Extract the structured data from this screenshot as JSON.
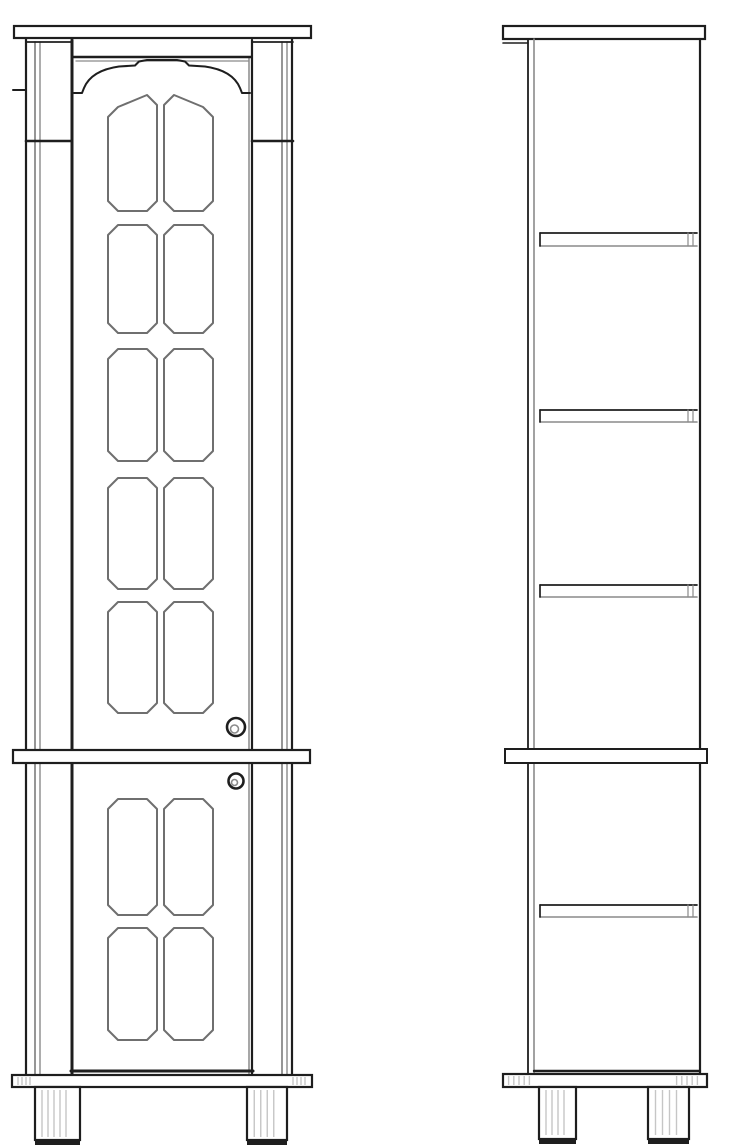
{
  "document": {
    "kind": "furniture-technical-drawing",
    "subject": "tall-cabinet",
    "views": [
      {
        "id": "front-elevation"
      },
      {
        "id": "side-elevation"
      }
    ]
  },
  "canvas": {
    "width": 745,
    "height": 1146,
    "background": "#ffffff"
  },
  "colors": {
    "ink": "#1e1e1e",
    "grey": "#8a8a8a",
    "mid": "#6f6f6f",
    "light": "#c6c6c6",
    "fill": "#ffffff"
  },
  "drawing": {
    "front": [
      {
        "t": "line",
        "name": "left-stile-outer-edge",
        "x1": 26,
        "y1": 38,
        "x2": 26,
        "y2": 1076,
        "sw": 2.2
      },
      {
        "t": "line",
        "name": "left-stile-inner-line-a",
        "x1": 35,
        "y1": 42,
        "x2": 35,
        "y2": 1076,
        "sw": 1.8,
        "c": "grey"
      },
      {
        "t": "line",
        "name": "left-stile-inner-line-b",
        "x1": 40,
        "y1": 42,
        "x2": 40,
        "y2": 1076,
        "sw": 1.4,
        "c": "grey"
      },
      {
        "t": "line",
        "name": "right-stile-inner-line-a",
        "x1": 282,
        "y1": 42,
        "x2": 282,
        "y2": 1076,
        "sw": 1.8,
        "c": "grey"
      },
      {
        "t": "line",
        "name": "right-stile-inner-line-b",
        "x1": 287,
        "y1": 42,
        "x2": 287,
        "y2": 1076,
        "sw": 1.4,
        "c": "grey"
      },
      {
        "t": "line",
        "name": "right-stile-outer-edge",
        "x1": 292,
        "y1": 38,
        "x2": 292,
        "y2": 1076,
        "sw": 2.2
      },
      {
        "t": "line",
        "name": "door-left-stile",
        "x1": 72,
        "y1": 40,
        "x2": 72,
        "y2": 1074,
        "sw": 3
      },
      {
        "t": "line",
        "name": "door-right-inner-line",
        "x1": 249,
        "y1": 58,
        "x2": 249,
        "y2": 1074,
        "sw": 1.5,
        "c": "grey"
      },
      {
        "t": "line",
        "name": "door-right-stile",
        "x1": 252,
        "y1": 40,
        "x2": 252,
        "y2": 1074,
        "sw": 2.2
      },
      {
        "t": "line",
        "name": "capital-top-left",
        "x1": 26,
        "y1": 42,
        "x2": 72,
        "y2": 42,
        "sw": 1.8
      },
      {
        "t": "line",
        "name": "capital-top-right",
        "x1": 252,
        "y1": 42,
        "x2": 293,
        "y2": 42,
        "sw": 1.8
      },
      {
        "t": "line",
        "name": "capital-bottom-left",
        "x1": 26,
        "y1": 141,
        "x2": 72,
        "y2": 141,
        "sw": 2.6
      },
      {
        "t": "line",
        "name": "capital-bottom-right",
        "x1": 252,
        "y1": 141,
        "x2": 293,
        "y2": 141,
        "sw": 2.6
      },
      {
        "t": "line",
        "name": "pilaster-collar-tick",
        "x1": 13,
        "y1": 90,
        "x2": 26,
        "y2": 90,
        "sw": 2
      },
      {
        "t": "line",
        "name": "door-top-rail",
        "x1": 73,
        "y1": 57,
        "x2": 251,
        "y2": 57,
        "sw": 2.4
      },
      {
        "t": "line",
        "name": "door-top-rail-shadow",
        "x1": 76,
        "y1": 61,
        "x2": 248,
        "y2": 61,
        "sw": 1.3,
        "c": "grey"
      },
      {
        "t": "path",
        "name": "door-arch",
        "d": "M74,93 L82,93 L84,88 C89,76 101,69 119,66.5 L135,65.5 L139,61.5 L147,60 L177,60 L185,61.5 L189,65.5 L205,66.5 C223,69 235,76 240,88 L242,93 L250,93",
        "sw": 2
      },
      {
        "t": "panel",
        "name": "upper-panel-r1-left",
        "x": 108,
        "y": 95,
        "w": 49,
        "h": 116,
        "tl": 12
      },
      {
        "t": "panel",
        "name": "upper-panel-r1-right",
        "x": 164,
        "y": 95,
        "w": 49,
        "h": 116,
        "tr": 12
      },
      {
        "t": "panel",
        "name": "upper-panel-r2-left",
        "x": 108,
        "y": 225,
        "w": 49,
        "h": 108
      },
      {
        "t": "panel",
        "name": "upper-panel-r2-right",
        "x": 164,
        "y": 225,
        "w": 49,
        "h": 108
      },
      {
        "t": "panel",
        "name": "upper-panel-r3-left",
        "x": 108,
        "y": 349,
        "w": 49,
        "h": 112
      },
      {
        "t": "panel",
        "name": "upper-panel-r3-right",
        "x": 164,
        "y": 349,
        "w": 49,
        "h": 112
      },
      {
        "t": "panel",
        "name": "upper-panel-r4-left",
        "x": 108,
        "y": 478,
        "w": 49,
        "h": 111
      },
      {
        "t": "panel",
        "name": "upper-panel-r4-right",
        "x": 164,
        "y": 478,
        "w": 49,
        "h": 111
      },
      {
        "t": "panel",
        "name": "upper-panel-r5-left",
        "x": 108,
        "y": 602,
        "w": 49,
        "h": 111
      },
      {
        "t": "panel",
        "name": "upper-panel-r5-right",
        "x": 164,
        "y": 602,
        "w": 49,
        "h": 111
      },
      {
        "t": "circle",
        "name": "upper-door-knob",
        "cx": 236,
        "cy": 727,
        "r": 9,
        "sw": 2.6
      },
      {
        "t": "circle",
        "name": "upper-door-knob-center",
        "cx": 234.5,
        "cy": 729,
        "r": 4,
        "sw": 1.6,
        "c": "grey"
      },
      {
        "t": "rect",
        "name": "middle-rail",
        "x": 13,
        "y": 750,
        "w": 297,
        "h": 13,
        "sw": 2.2,
        "f": "fill"
      },
      {
        "t": "circle",
        "name": "lower-door-knob",
        "cx": 236,
        "cy": 781,
        "r": 7.5,
        "sw": 2.6
      },
      {
        "t": "circle",
        "name": "lower-door-knob-center",
        "cx": 234.5,
        "cy": 782.5,
        "r": 3,
        "sw": 1.6,
        "c": "grey"
      },
      {
        "t": "panel",
        "name": "lower-panel-r1-left",
        "x": 108,
        "y": 799,
        "w": 49,
        "h": 116
      },
      {
        "t": "panel",
        "name": "lower-panel-r1-right",
        "x": 164,
        "y": 799,
        "w": 49,
        "h": 116
      },
      {
        "t": "panel",
        "name": "lower-panel-r2-left",
        "x": 108,
        "y": 928,
        "w": 49,
        "h": 112
      },
      {
        "t": "panel",
        "name": "lower-panel-r2-right",
        "x": 164,
        "y": 928,
        "w": 49,
        "h": 112
      },
      {
        "t": "line",
        "name": "door-bottom-rail",
        "x1": 71,
        "y1": 1071,
        "x2": 253,
        "y2": 1071,
        "sw": 3
      },
      {
        "t": "rect",
        "name": "plinth-rail",
        "x": 12,
        "y": 1075,
        "w": 300,
        "h": 12,
        "sw": 2.2,
        "f": "fill"
      },
      {
        "t": "hatch",
        "name": "plinth-hatch-left",
        "x": 16,
        "y": 1077,
        "w": 16,
        "h": 8,
        "n": 4
      },
      {
        "t": "hatch",
        "name": "plinth-hatch-right",
        "x": 291,
        "y": 1077,
        "w": 16,
        "h": 8,
        "n": 4
      },
      {
        "t": "rect",
        "name": "left-foot",
        "x": 35,
        "y": 1087,
        "w": 45,
        "h": 53,
        "sw": 2.2,
        "f": "fill"
      },
      {
        "t": "hatch",
        "name": "left-foot-hatch",
        "x": 39,
        "y": 1090,
        "w": 30,
        "h": 47,
        "n": 5
      },
      {
        "t": "rect",
        "name": "left-foot-base",
        "x": 35,
        "y": 1139,
        "w": 45,
        "h": 6,
        "sw": 0,
        "f": "ink"
      },
      {
        "t": "rect",
        "name": "right-foot",
        "x": 247,
        "y": 1087,
        "w": 40,
        "h": 53,
        "sw": 2.2,
        "f": "fill"
      },
      {
        "t": "hatch",
        "name": "right-foot-hatch",
        "x": 251,
        "y": 1090,
        "w": 26,
        "h": 47,
        "n": 4
      },
      {
        "t": "rect",
        "name": "right-foot-base",
        "x": 247,
        "y": 1139,
        "w": 40,
        "h": 6,
        "sw": 0,
        "f": "ink"
      },
      {
        "t": "rect",
        "name": "cornice-board",
        "x": 14,
        "y": 26,
        "w": 297,
        "h": 12,
        "sw": 2.2,
        "f": "fill"
      }
    ],
    "side": [
      {
        "t": "rect",
        "name": "top-board",
        "x": 503,
        "y": 26,
        "w": 202,
        "h": 13,
        "sw": 2.2,
        "f": "fill"
      },
      {
        "t": "line",
        "name": "top-board-lip",
        "x1": 503,
        "y1": 43,
        "x2": 528,
        "y2": 43,
        "sw": 1.6
      },
      {
        "t": "line",
        "name": "front-edge-outer",
        "x1": 528,
        "y1": 39,
        "x2": 528,
        "y2": 1075,
        "sw": 1.8
      },
      {
        "t": "line",
        "name": "front-edge-inner",
        "x1": 534,
        "y1": 39,
        "x2": 534,
        "y2": 1075,
        "sw": 1.6,
        "c": "grey"
      },
      {
        "t": "line",
        "name": "back-edge",
        "x1": 700,
        "y1": 39,
        "x2": 700,
        "y2": 1073,
        "sw": 2.2
      },
      {
        "t": "line",
        "name": "shelf-1-top",
        "x1": 540,
        "y1": 233,
        "x2": 697,
        "y2": 233,
        "sw": 1.7
      },
      {
        "t": "line",
        "name": "shelf-1-bottom",
        "x1": 540,
        "y1": 246,
        "x2": 697,
        "y2": 246,
        "sw": 1.6,
        "c": "grey"
      },
      {
        "t": "line",
        "name": "shelf-1-front-cap",
        "x1": 540,
        "y1": 233,
        "x2": 540,
        "y2": 246,
        "sw": 1.7
      },
      {
        "t": "line",
        "name": "shelf-1-peg-a",
        "x1": 688,
        "y1": 233,
        "x2": 688,
        "y2": 246,
        "sw": 1.2,
        "c": "grey"
      },
      {
        "t": "line",
        "name": "shelf-1-peg-b",
        "x1": 693,
        "y1": 233,
        "x2": 693,
        "y2": 246,
        "sw": 1.2,
        "c": "grey"
      },
      {
        "t": "line",
        "name": "shelf-2-top",
        "x1": 540,
        "y1": 410,
        "x2": 697,
        "y2": 410,
        "sw": 1.7
      },
      {
        "t": "line",
        "name": "shelf-2-bottom",
        "x1": 540,
        "y1": 422,
        "x2": 697,
        "y2": 422,
        "sw": 1.6,
        "c": "grey"
      },
      {
        "t": "line",
        "name": "shelf-2-front-cap",
        "x1": 540,
        "y1": 410,
        "x2": 540,
        "y2": 422,
        "sw": 1.7
      },
      {
        "t": "line",
        "name": "shelf-2-peg-a",
        "x1": 688,
        "y1": 410,
        "x2": 688,
        "y2": 422,
        "sw": 1.2,
        "c": "grey"
      },
      {
        "t": "line",
        "name": "shelf-2-peg-b",
        "x1": 693,
        "y1": 410,
        "x2": 693,
        "y2": 422,
        "sw": 1.2,
        "c": "grey"
      },
      {
        "t": "line",
        "name": "shelf-3-top",
        "x1": 540,
        "y1": 585,
        "x2": 697,
        "y2": 585,
        "sw": 1.7
      },
      {
        "t": "line",
        "name": "shelf-3-bottom",
        "x1": 540,
        "y1": 597,
        "x2": 697,
        "y2": 597,
        "sw": 1.6,
        "c": "grey"
      },
      {
        "t": "line",
        "name": "shelf-3-front-cap",
        "x1": 540,
        "y1": 585,
        "x2": 540,
        "y2": 597,
        "sw": 1.7
      },
      {
        "t": "line",
        "name": "shelf-3-peg-a",
        "x1": 688,
        "y1": 585,
        "x2": 688,
        "y2": 597,
        "sw": 1.2,
        "c": "grey"
      },
      {
        "t": "line",
        "name": "shelf-3-peg-b",
        "x1": 693,
        "y1": 585,
        "x2": 693,
        "y2": 597,
        "sw": 1.2,
        "c": "grey"
      },
      {
        "t": "rect",
        "name": "middle-rail-side",
        "x": 505,
        "y": 749,
        "w": 202,
        "h": 14,
        "sw": 2,
        "f": "fill"
      },
      {
        "t": "line",
        "name": "shelf-4-top",
        "x1": 540,
        "y1": 905,
        "x2": 697,
        "y2": 905,
        "sw": 1.7
      },
      {
        "t": "line",
        "name": "shelf-4-bottom",
        "x1": 540,
        "y1": 917,
        "x2": 697,
        "y2": 917,
        "sw": 1.6,
        "c": "grey"
      },
      {
        "t": "line",
        "name": "shelf-4-front-cap",
        "x1": 540,
        "y1": 905,
        "x2": 540,
        "y2": 917,
        "sw": 1.7
      },
      {
        "t": "line",
        "name": "shelf-4-peg-a",
        "x1": 688,
        "y1": 905,
        "x2": 688,
        "y2": 917,
        "sw": 1.2,
        "c": "grey"
      },
      {
        "t": "line",
        "name": "shelf-4-peg-b",
        "x1": 693,
        "y1": 905,
        "x2": 693,
        "y2": 917,
        "sw": 1.2,
        "c": "grey"
      },
      {
        "t": "line",
        "name": "carcass-bottom-edge",
        "x1": 534,
        "y1": 1071,
        "x2": 700,
        "y2": 1071,
        "sw": 2.4
      },
      {
        "t": "rect",
        "name": "plinth-rail-side",
        "x": 503,
        "y": 1074,
        "w": 204,
        "h": 13,
        "sw": 2.2,
        "f": "fill"
      },
      {
        "t": "hatch",
        "name": "plinth-side-hatch-left",
        "x": 506,
        "y": 1076,
        "w": 26,
        "h": 9,
        "n": 5
      },
      {
        "t": "hatch",
        "name": "plinth-side-hatch-right",
        "x": 674,
        "y": 1076,
        "w": 26,
        "h": 9,
        "n": 5
      },
      {
        "t": "rect",
        "name": "side-front-foot",
        "x": 539,
        "y": 1087,
        "w": 37,
        "h": 52,
        "sw": 2.2,
        "f": "fill"
      },
      {
        "t": "hatch",
        "name": "side-front-foot-hatch",
        "x": 543,
        "y": 1090,
        "w": 24,
        "h": 45,
        "n": 4
      },
      {
        "t": "rect",
        "name": "side-front-foot-base",
        "x": 539,
        "y": 1138,
        "w": 37,
        "h": 6,
        "sw": 0,
        "f": "ink"
      },
      {
        "t": "rect",
        "name": "side-back-foot",
        "x": 648,
        "y": 1087,
        "w": 41,
        "h": 52,
        "sw": 2.2,
        "f": "fill"
      },
      {
        "t": "hatch",
        "name": "side-back-foot-hatch",
        "x": 652,
        "y": 1090,
        "w": 28,
        "h": 45,
        "n": 4
      },
      {
        "t": "rect",
        "name": "side-back-foot-base",
        "x": 648,
        "y": 1138,
        "w": 41,
        "h": 6,
        "sw": 0,
        "f": "ink"
      }
    ]
  }
}
